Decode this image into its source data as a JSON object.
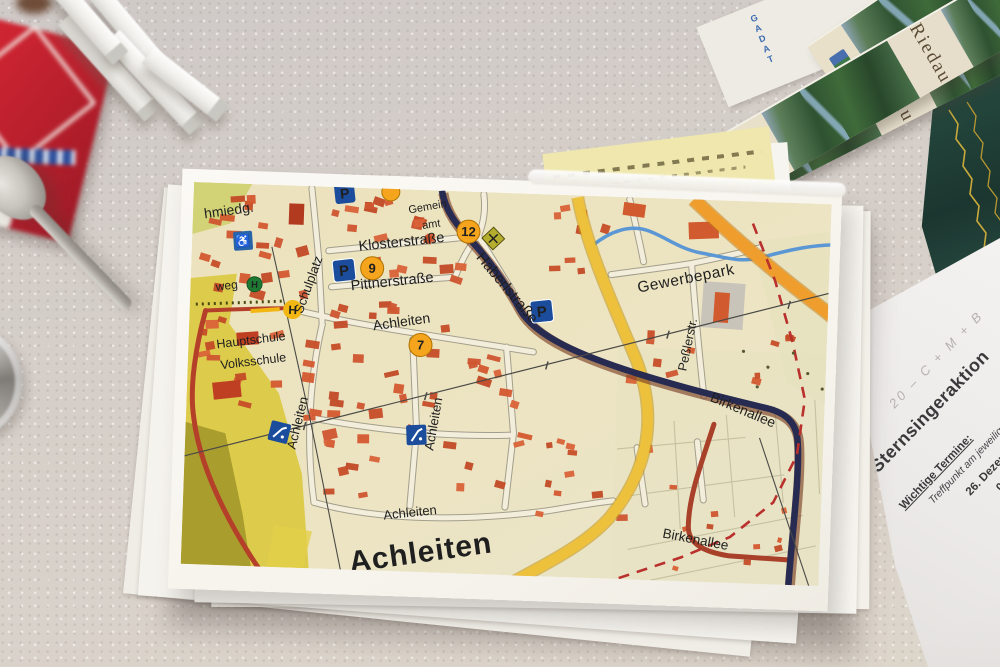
{
  "map": {
    "district_label": "Achleiten",
    "street_labels": {
      "schmiedgasse_partial": "hmiedg.",
      "schulplatz": "Schulplatz",
      "klosterstrasse": "Klosterstraße",
      "pittnerstrasse": "Pittnerstraße",
      "achleiten_north": "Achleiten",
      "achleiten_west_vertical": "Achleiten",
      "achleiten_mid_vertical": "Achleiten",
      "achleiten_south": "Achleiten",
      "haberlstrasse": "Haberlstraße",
      "gewerbepark": "Gewerbepark",
      "pesslerstrasse": "Peßlerstr.",
      "birkenallee_upper": "Birkenallee",
      "birkenallee_lower": "Birkenallee",
      "hauptschule": "Hauptschule",
      "volksschule": "Volksschule",
      "weg_partial": "weg",
      "gemeindeamt_partial_line1": "Gemein",
      "gemeindeamt_partial_line2": "amt"
    },
    "route_markers": {
      "marker_12": "12",
      "marker_9": "9",
      "marker_7": "7"
    },
    "icon_letters": {
      "parking": "P",
      "bus_stop": "H",
      "hotel": "H",
      "wc": "♿"
    },
    "colors": {
      "building": "#cf5430",
      "main_road": "#272b52",
      "collector_road": "#eec13c",
      "highway": "#ef9d2c",
      "minor_red_road": "#b5402a",
      "stream": "#5b97d4",
      "boundary": "#b9302c",
      "field": "#dcc93f",
      "marker_fill": "#f4a41d",
      "parking_blue": "#1c4d9c"
    }
  },
  "brochures": {
    "title": "Riedau",
    "envelope_text": "GADAT"
  },
  "document": {
    "chalk_blessing": "20 – C + M + B",
    "title": "Sternsingeraktion",
    "heading": "Wichtige Termine:",
    "line_meeting": "Treffpunkt am jeweiligen Sterns",
    "date_1": "26. Dezember 2018:",
    "date_2": "06. Jänner 2019:"
  }
}
